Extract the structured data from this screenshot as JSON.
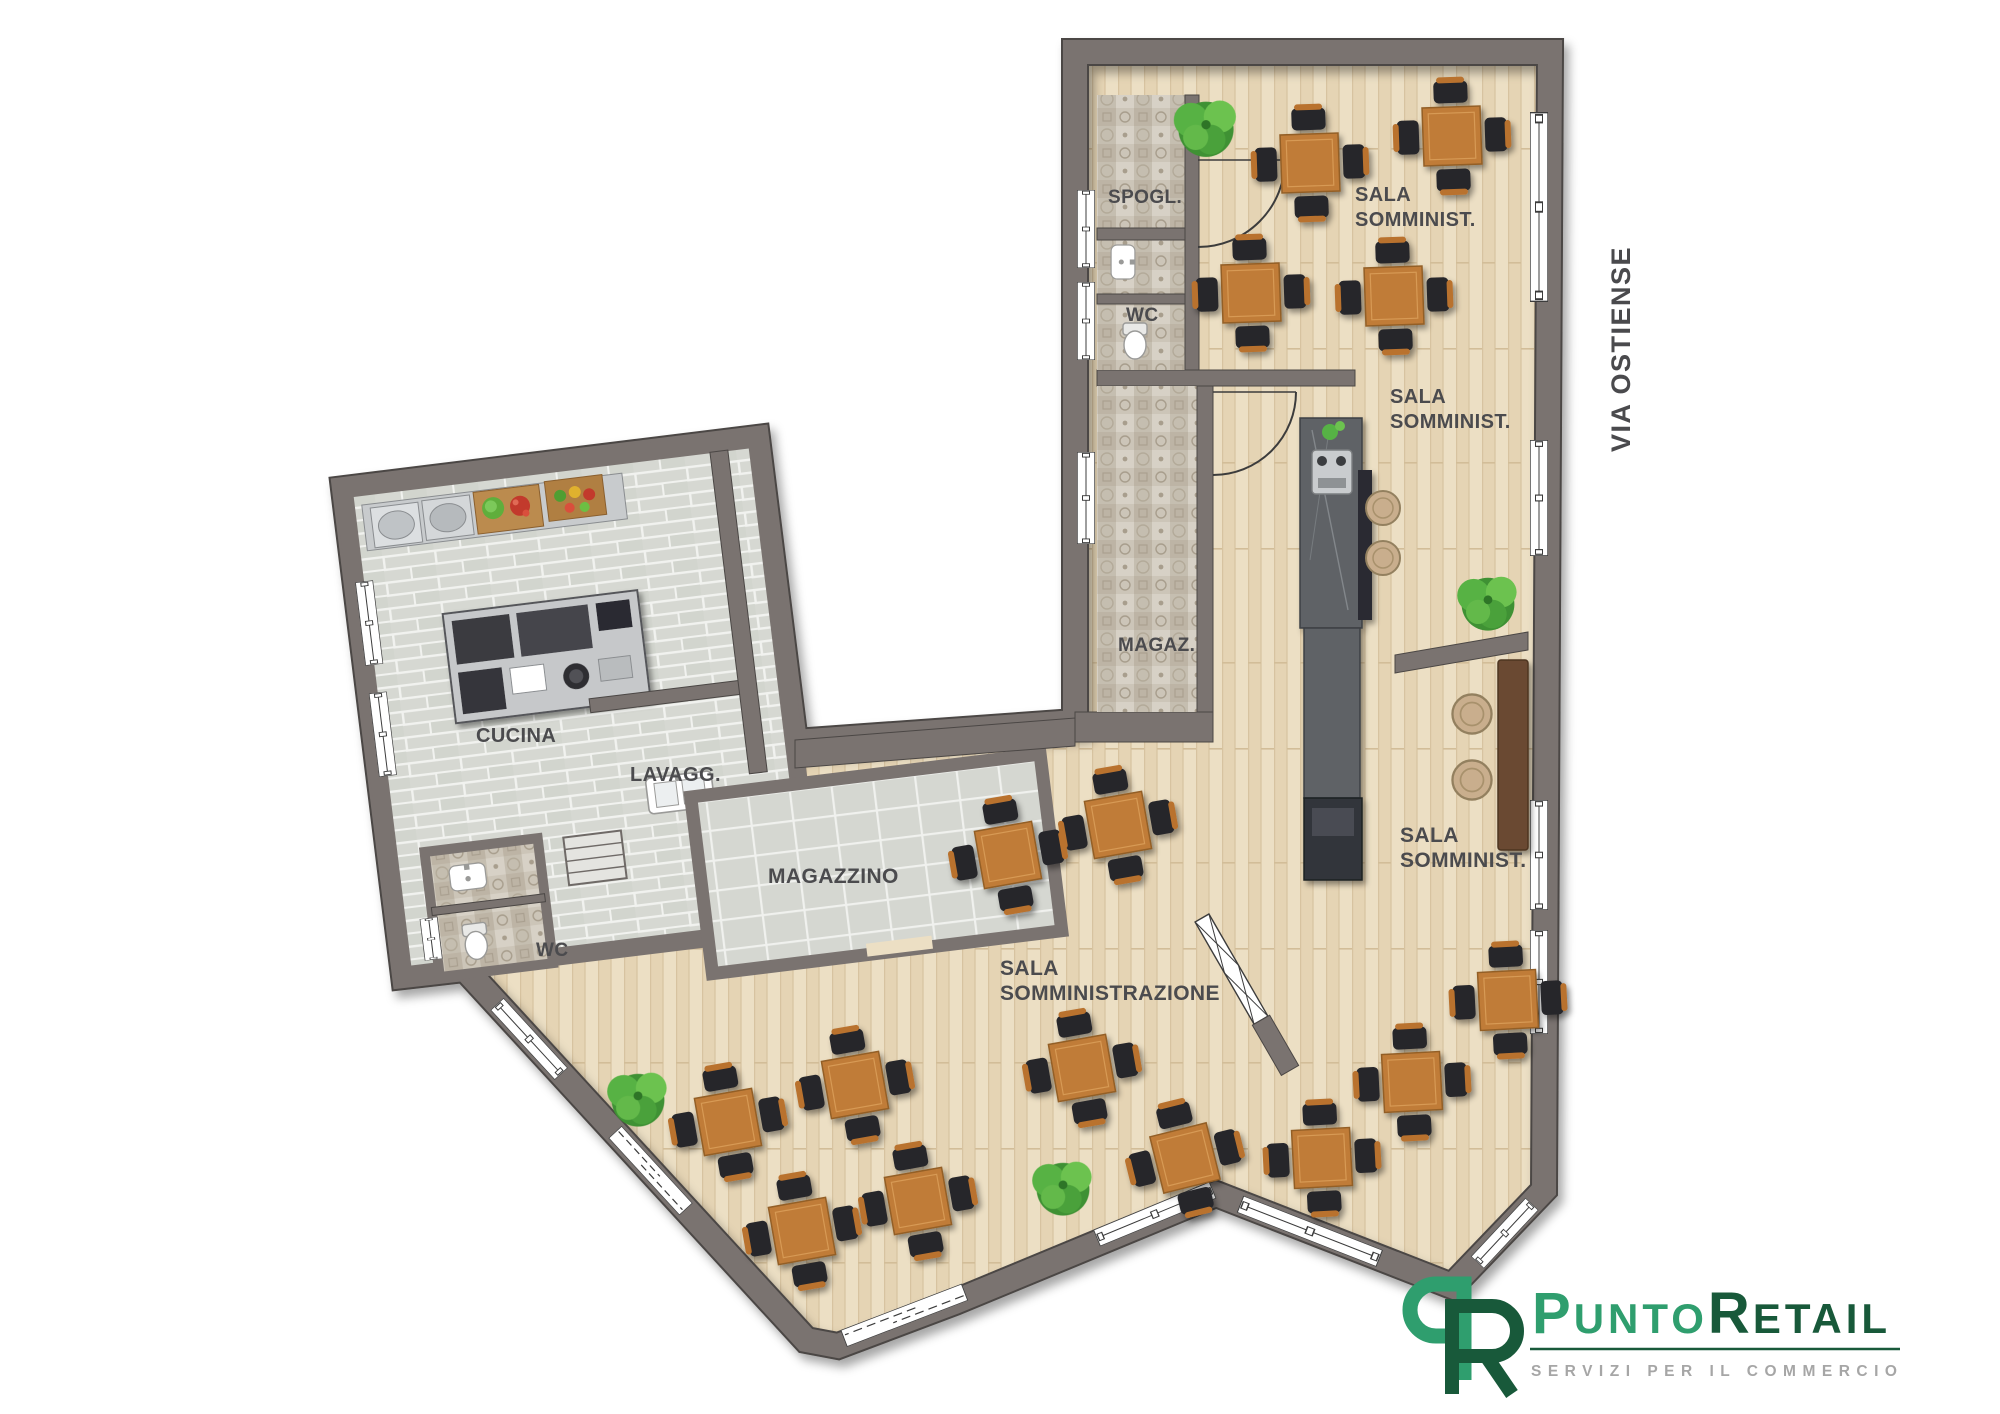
{
  "street_label": "VIA OSTIENSE",
  "rooms": {
    "spogl": "SPOGL.",
    "wc_top": "WC",
    "magaz": "MAGAZ.",
    "cucina": "CUCINA",
    "lavagg": "LAVAGG.",
    "magazzino": "MAGAZZINO",
    "wc_left": "WC",
    "sala1": {
      "line1": "SALA",
      "line2": "SOMMINIST."
    },
    "sala2": {
      "line1": "SALA",
      "line2": "SOMMINIST."
    },
    "sala3": {
      "line1": "SALA",
      "line2": "SOMMINIST."
    },
    "sala_main": {
      "line1": "SALA",
      "line2": "SOMMINISTRAZIONE"
    }
  },
  "logo": {
    "word1_initial": "P",
    "word1_rest": "UNTO",
    "word2_initial": "R",
    "word2_rest": "ETAIL",
    "tagline": "SERVIZI PER IL COMMERCIO",
    "green": "#2f9e6e",
    "dark_green": "#18593a",
    "tagline_color": "#a6a6a6"
  },
  "palette": {
    "wall": "#7a7370",
    "wood_floor": "#ecdfc4",
    "kitchen_tile": "#d7d9d3",
    "patterned_tile": "#cbc4b8",
    "table_wood": "#c07c38",
    "chair": "#26262b",
    "counter_stone": "#5f6266",
    "plant_green": "#57b244",
    "label_text": "#4b4b4e"
  },
  "furniture": {
    "dining_tables": 15,
    "bar_stools": 2,
    "lounge_stools": 2,
    "plants": 4,
    "bench": 1
  }
}
